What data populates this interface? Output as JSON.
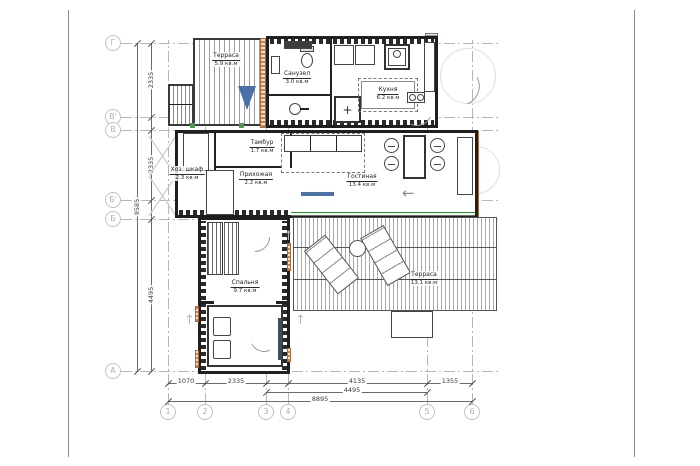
{
  "drawing": {
    "type": "floor-plan"
  },
  "rooms": [
    {
      "id": "terrace-top",
      "name": "Терраса",
      "area": "5.9 кв.м"
    },
    {
      "id": "bathroom",
      "name": "Санузел",
      "area": "3.0 кв.м"
    },
    {
      "id": "kitchen",
      "name": "Кухня",
      "area": "6.2 кв.м"
    },
    {
      "id": "tambour",
      "name": "Тамбур",
      "area": "1.7 кв.м"
    },
    {
      "id": "utility-closet",
      "name": "Хоз. шкаф",
      "area": "2.3 кв.м"
    },
    {
      "id": "hallway",
      "name": "Прихожая",
      "area": "2.2 кв.м"
    },
    {
      "id": "living-room",
      "name": "Гостиная",
      "area": "13.4 кв.м"
    },
    {
      "id": "bedroom",
      "name": "Спальня",
      "area": "9.7 кв.м"
    },
    {
      "id": "terrace-bottom",
      "name": "Терраса",
      "area": "13.1 кв.м"
    }
  ],
  "grid": {
    "rows": [
      "Г",
      "В'",
      "В",
      "Б'",
      "Б",
      "А"
    ],
    "cols": [
      "1",
      "2",
      "3",
      "4",
      "5",
      "6"
    ]
  },
  "dimensions": {
    "bottom_row1": [
      "1070",
      "2335",
      "4135",
      "1355"
    ],
    "bottom_row2": "4495",
    "bottom_row3": "8895",
    "left_segments": [
      "2335",
      "2335",
      "4495"
    ],
    "left_total": "9585"
  },
  "symbols": {
    "left_arrow": "←",
    "up_arrow": "↑",
    "plus": "+"
  },
  "colors": {
    "wall": "#1f1f1f",
    "orange_hatch": "#c8824f",
    "window_green": "#3f8f3f",
    "accent_blue": "#4a72a8",
    "grid_gray": "#b6b6b6"
  }
}
